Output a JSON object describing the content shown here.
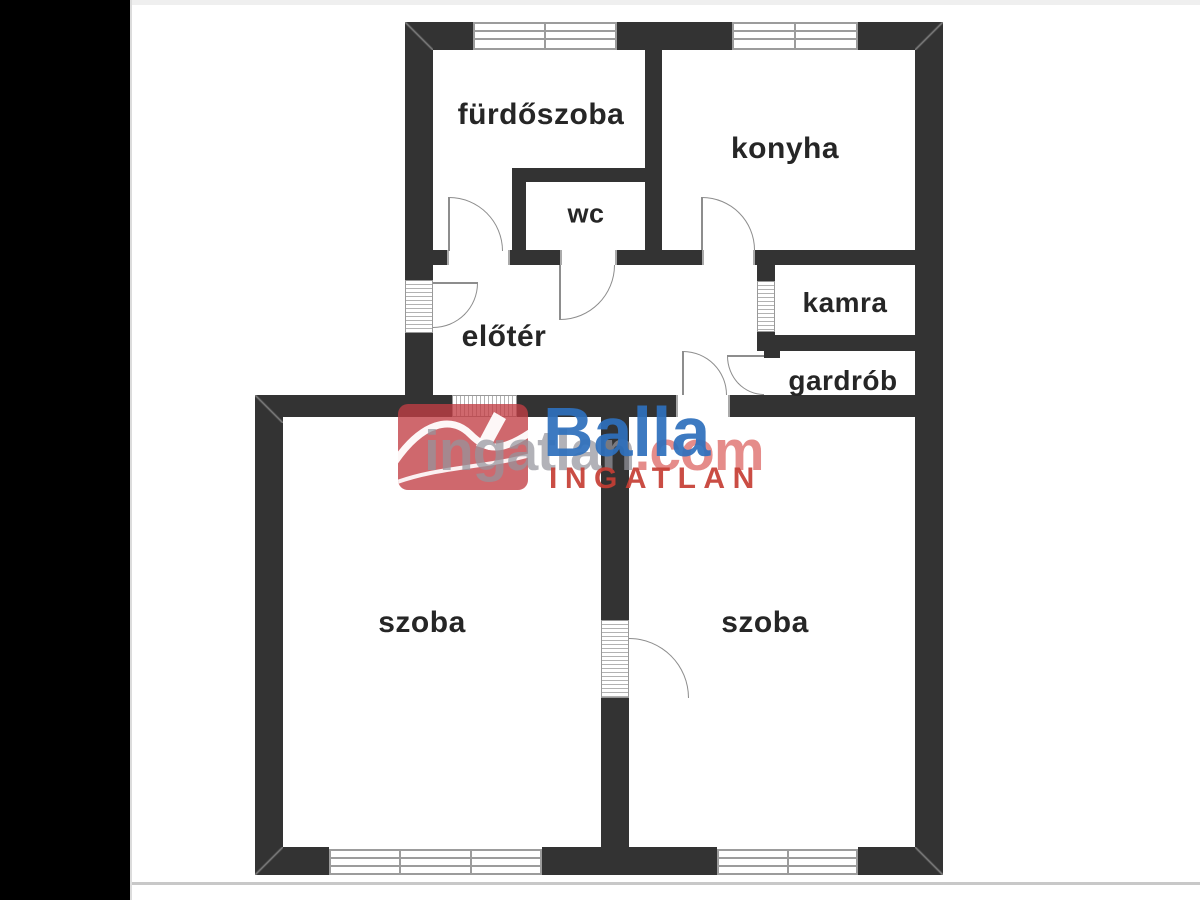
{
  "floorplan": {
    "rooms": [
      {
        "id": "furdoszoba",
        "label": "fürdőszoba"
      },
      {
        "id": "konyha",
        "label": "konyha"
      },
      {
        "id": "wc",
        "label": "wc"
      },
      {
        "id": "eloter",
        "label": "előtér"
      },
      {
        "id": "kamra",
        "label": "kamra"
      },
      {
        "id": "gardrob",
        "label": "gardrób"
      },
      {
        "id": "szoba_left",
        "label": "szoba"
      },
      {
        "id": "szoba_right",
        "label": "szoba"
      }
    ]
  },
  "watermarks": {
    "portal": {
      "text_main": "ingatlan",
      "text_suffix": ".com"
    },
    "agency": {
      "name": "Balla",
      "subtitle": "INGATLAN"
    }
  },
  "colors": {
    "wall": "#333333",
    "symbol_gray": "#9c9c9c",
    "label_text": "#262626",
    "left_bar": "#000000",
    "portal_red_box": "#c13e44",
    "portal_text": "#94949c",
    "portal_com": "#e17876",
    "agency_blue": "#2e70bc",
    "agency_red": "#c53e34"
  }
}
